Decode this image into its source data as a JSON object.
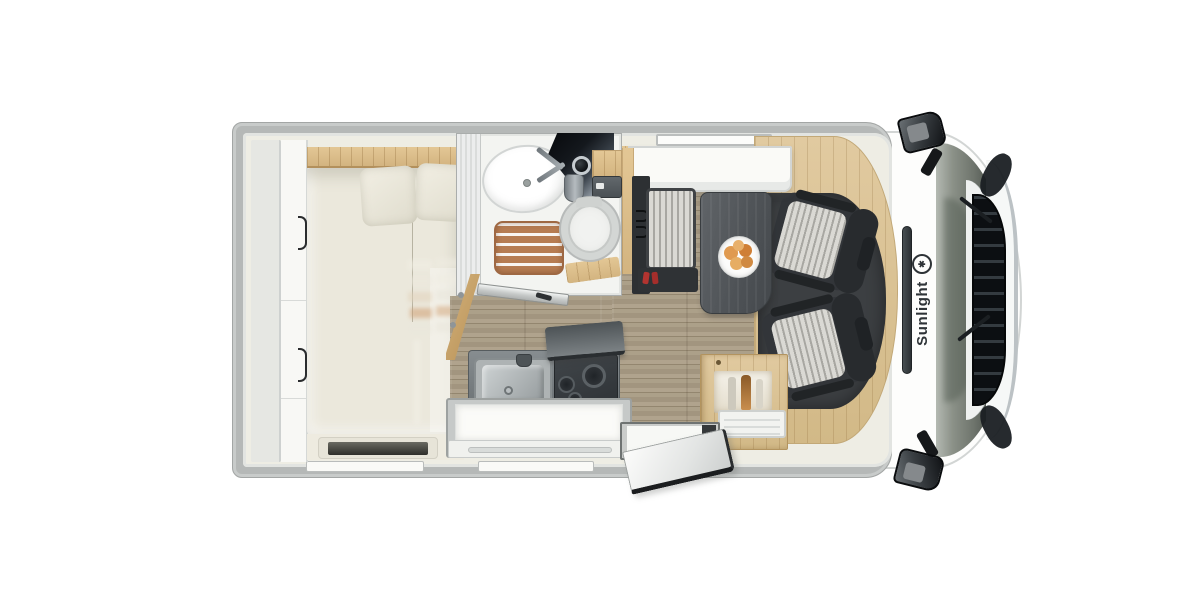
{
  "brand": {
    "label": "Sunlight",
    "logo_icon": "sunlight-sun-logo-icon"
  },
  "view": {
    "type": "motorhome-floorplan-top-view",
    "background": "#ffffff"
  },
  "colors": {
    "body_wall": "#b5b8b7",
    "interior_cream": "#eeede4",
    "floor_wood": "#a79a8b",
    "furniture_wood": "#d9bd90",
    "mattress": "#ebe8dc",
    "upholstery_dark": "#323539",
    "upholstery_stripe": "#d9d8d3",
    "kitchen_counter": "#6b7174",
    "shower_teak": "#b67c52",
    "fruit_orange": "#e09a50",
    "seatbelt_red": "#b23430",
    "cab_glass": "#454b45"
  },
  "areas": [
    {
      "name": "rear-garage-shelf"
    },
    {
      "name": "wardrobe"
    },
    {
      "name": "transverse-double-bed"
    },
    {
      "name": "washroom-shower-toilet-sink"
    },
    {
      "name": "corridor"
    },
    {
      "name": "kitchen-sink-and-hob"
    },
    {
      "name": "dinette-table-and-bench"
    },
    {
      "name": "entry-door-open"
    },
    {
      "name": "swivel-cab-seats"
    },
    {
      "name": "driver-cab"
    }
  ]
}
